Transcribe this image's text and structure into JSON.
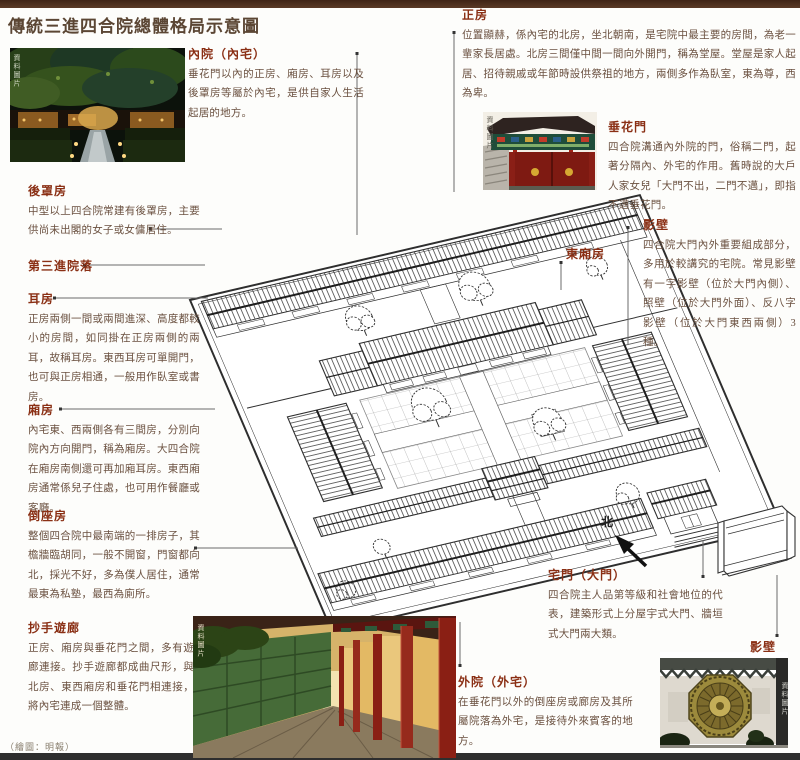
{
  "page": {
    "title": "傳統三進四合院總體格局示意圖",
    "credit": "（繪圖：明報）",
    "photo_credit": "資料圖片",
    "colors": {
      "top_bar": "#4a2c1d",
      "heading": "#8a2f14",
      "body_text": "#6b5140",
      "leader_line": "#6b6b6b"
    }
  },
  "blocks": {
    "neiyuan": {
      "title": "內院（內宅）",
      "body": "垂花門以內的正房、廂房、耳房以及後罩房等屬於內宅，是供自家人生活起居的地方。"
    },
    "houzhaofang": {
      "title": "後罩房",
      "body": "中型以上四合院常建有後罩房，主要供尚未出閣的女子或女傭居住。"
    },
    "disanjin": {
      "title": "第三進院落"
    },
    "erfang": {
      "title": "耳房",
      "body": "正房兩側一間或兩間進深、高度都較小的房間，如同掛在正房兩側的兩耳，故稱耳房。東西耳房可單開門，也可與正房相通，一般用作臥室或書房。"
    },
    "xiangfang": {
      "title": "廂房",
      "body": "內宅東、西兩側各有三間房，分別向院內方向開門，稱為廂房。大四合院在廂房南側還可再加廂耳房。東西廂房通常係兒子住處，也可用作餐廳或客廳。"
    },
    "daozuofang": {
      "title": "倒座房",
      "body": "整個四合院中最南端的一排房子，其檐牆臨胡同，一般不開窗，門窗都向北，採光不好，多為僕人居住，通常最東為私塾，最西為廁所。"
    },
    "chaoshouyoulang": {
      "title": "抄手遊廊",
      "body": "正房、廂房與垂花門之間，多有遊廊連接。抄手遊廊都成曲尺形，與北房、東西廂房和垂花門相連接，將內宅連成一個整體。"
    },
    "zhengfang": {
      "title": "正房",
      "body": "位置顯赫，係內宅的北房，坐北朝南，是宅院中最主要的房間，為老一輩家長居處。北房三間僅中間一間向外開門，稱為堂屋。堂屋是家人起居、招待親戚或年節時設供祭祖的地方，兩側多作為臥室，東為尊，西為卑。"
    },
    "chuihuamen": {
      "title": "垂花門",
      "body": "四合院溝通內外院的門，俗稱二門，起著分隔內、外宅的作用。舊時說的大戶人家女兒「大門不出，二門不邁」，即指不邁垂花門。"
    },
    "yingbi": {
      "title": "影壁",
      "body": "四合院大門內外重要組成部分，多用於較講究的宅院。常見影壁有一字影壁（位於大門內側）、照壁（位於大門外面）、反八字影壁（位於大門東西兩側）3種。"
    },
    "zhaimen": {
      "title": "宅門（大門）",
      "body": "四合院主人品第等級和社會地位的代表，建築形式上分屋宇式大門、牆垣式大門兩大類。"
    },
    "waiyuan": {
      "title": "外院（外宅）",
      "body": "在垂花門以外的倒座房或廊房及其所屬院落為外宅，是接待外來賓客的地方。"
    }
  },
  "labels": {
    "dongxiangfang": "東廂房",
    "north": "北",
    "yingbi_caption": "影壁"
  }
}
